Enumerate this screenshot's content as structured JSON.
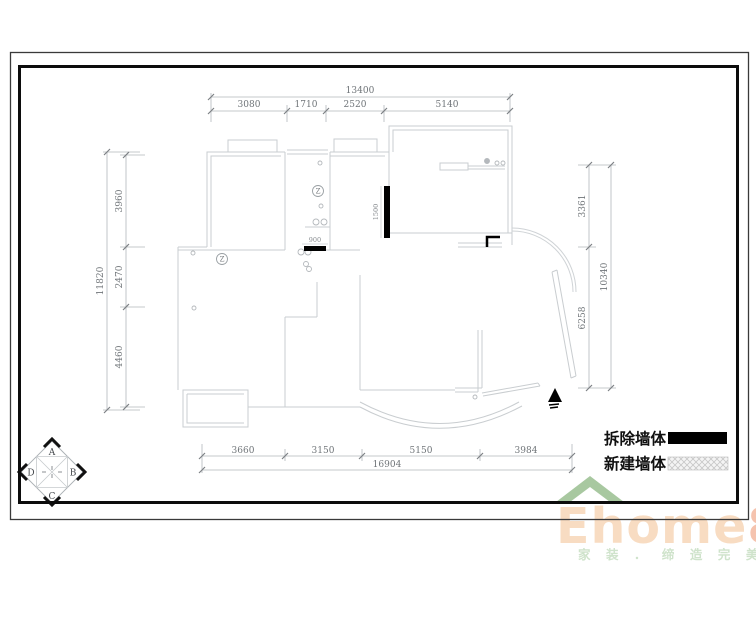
{
  "dims": {
    "top": {
      "total": "13400",
      "segments": [
        "3080",
        "1710",
        "2520",
        "5140"
      ]
    },
    "left": {
      "total": "11820",
      "segments": [
        "3960",
        "2470",
        "4460"
      ]
    },
    "right": {
      "total": "10340",
      "segments": [
        "3361",
        "6258"
      ]
    },
    "bottom": {
      "total": "16904",
      "segments": [
        "3660",
        "3150",
        "5150",
        "3984"
      ]
    },
    "inline": {
      "demolish_vertical": "1500",
      "demolish_horizontal": "900"
    }
  },
  "legend": {
    "demolish_label": "拆除墙体",
    "new_wall_label": "新建墙体"
  },
  "compass": {
    "top": "A",
    "right": "B",
    "bottom": "C",
    "left": "D"
  },
  "plan_symbols": {
    "z1": "Z",
    "z2": "Z"
  },
  "watermark": {
    "brand_main": "Ehome",
    "brand_digit": "8",
    "tagline": "家 装 ． 缔 造 完 美 生 活"
  },
  "colors": {
    "demolish_wall": "#000000",
    "wall_line": "#c9cdd0",
    "dim_line": "#b3b7bb",
    "dim_text": "#6f7478",
    "brand_text": "#f8dcc2",
    "brand_digit": "#f5c3ae",
    "roof_green": "#a8c8a0",
    "tagline_green": "#cfe3cb"
  }
}
